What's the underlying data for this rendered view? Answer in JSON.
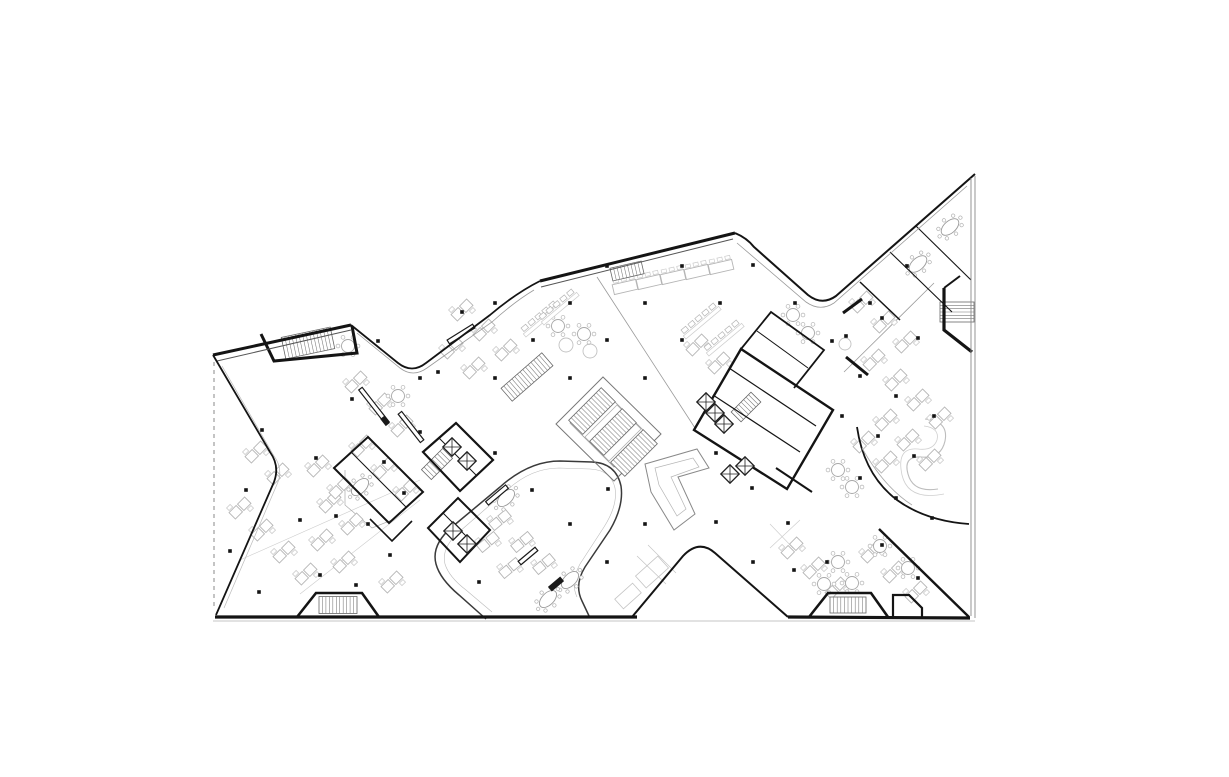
{
  "canvas": {
    "width": 1229,
    "height": 777,
    "background": "#ffffff"
  },
  "palette": {
    "paper": "#ffffff",
    "ink": "#141414",
    "wall": "#1c1c1c",
    "mid": "#555555",
    "light": "#b5b5b5",
    "faint": "#cccccc",
    "ghost": "#dddddd"
  },
  "plan": {
    "outline": [
      {
        "p": "M213,355 L351,325",
        "w": 3,
        "c": "#141414",
        "n": "facade-northwest-left-wing"
      },
      {
        "p": "M217,361 L351,330",
        "w": 1,
        "c": "#555555",
        "n": "facade-inner-line"
      },
      {
        "p": "M351,325 L398,363 Q412,374 426,363 L490,315 Q516,293 540,281",
        "w": 1.8,
        "c": "#141414",
        "n": "notch-top-left-edge"
      },
      {
        "p": "M357,333 L400,368 Q413,378 427,368 L492,322 Q514,302 534,290",
        "w": 0.8,
        "c": "#999999",
        "n": "notch-top-left-glass-line"
      },
      {
        "p": "M540,281 L735,233",
        "w": 3,
        "c": "#141414",
        "n": "facade-north-center-wing"
      },
      {
        "p": "M541,287 L733,239",
        "w": 1,
        "c": "#555555",
        "n": "facade-inner-line"
      },
      {
        "p": "M735,233 Q747,238 754,247 L808,295 Q822,306 836,296 L975,174",
        "w": 2,
        "c": "#141414",
        "n": "notch-top-right-edge"
      },
      {
        "p": "M737,243 L806,302 Q820,312 834,303 L967,186",
        "w": 0.8,
        "c": "#999999",
        "n": "notch-top-right-glass-line"
      },
      {
        "p": "M971,178 L971,616",
        "w": 0.9,
        "c": "#888888",
        "n": "facade-east-line"
      },
      {
        "p": "M975,176 L975,618",
        "w": 0.9,
        "c": "#888888",
        "n": "facade-east-line"
      },
      {
        "p": "M215,617 L637,617",
        "w": 3.2,
        "c": "#141414",
        "n": "facade-south-left"
      },
      {
        "p": "M632,617 L683,556 Q699,539 715,553 L788,617",
        "w": 2,
        "c": "#141414",
        "n": "notch-bottom-edge"
      },
      {
        "p": "M788,617 L970,618",
        "w": 3.2,
        "c": "#141414",
        "n": "facade-south-right"
      },
      {
        "p": "M213,621 L975,621",
        "w": 0.8,
        "c": "#b0b0b0",
        "n": "ground-shadow-line"
      },
      {
        "p": "M213,355 L270,452 Q280,466 274,482 L216,615",
        "w": 1.8,
        "c": "#141414",
        "n": "notch-west-edge"
      },
      {
        "p": "M214,362 L214,610",
        "w": 1,
        "c": "#888888",
        "s": "4 4",
        "n": "west-dashed-roof-line"
      },
      {
        "p": "M222,366 L274,456 Q283,468 278,482 L224,608",
        "w": 0.7,
        "c": "#bbbbbb",
        "n": "west-landscape-line"
      },
      {
        "p": "M879,529 L969,617",
        "w": 2.4,
        "c": "#141414",
        "n": "southeast-diagonal-wall"
      },
      {
        "p": "M857,427 Q864,475 897,500 Q926,521 969,524",
        "w": 1.8,
        "c": "#141414",
        "n": "terrace-boundary-curve"
      },
      {
        "p": "M862,448 Q884,487 912,505",
        "w": 0.8,
        "c": "#aaaaaa",
        "n": "terrace-inner-line"
      }
    ],
    "interior_lines": [
      {
        "p": "M486,619 L459,595 Q440,579 436,564 Q431,545 452,527 L500,487 Q529,461 560,461 L592,462 Q616,463 621,486 Q624,506 610,530 L585,567 Q574,585 582,601 L590,618",
        "w": 1.5,
        "c": "#3a3a3a",
        "n": "courtyard-loop-curve"
      },
      {
        "p": "M492,612 L466,590 Q449,577 445,564 Q441,548 459,532 L505,492 Q530,468 559,468 L590,469 Q611,470 615,488 Q618,505 604,527 L580,564 Q570,582 577,597",
        "w": 0.6,
        "c": "#bbbbbb",
        "n": "courtyard-loop-inner"
      },
      {
        "p": "M556,424 L603,377 L661,434 L614,481 Z",
        "w": 1,
        "c": "#777777",
        "n": "grand-stair-boundary"
      },
      {
        "p": "M570,423 L603,390 L647,434 L614,467 Z",
        "w": 0.8,
        "c": "#999999",
        "n": "grand-stair-inner"
      },
      {
        "p": "M585,437 L617,405 L641,429 L609,461 Z",
        "w": 0.7,
        "c": "#aaaaaa",
        "n": "grand-stair-inner"
      },
      {
        "p": "M645,464 L697,449 L709,468 L678,477 L695,514 L674,530 L651,492 Z",
        "w": 1,
        "c": "#888888",
        "n": "angular-feature-stair"
      },
      {
        "p": "M655,468 L693,458 L699,467 L671,477 L686,509 L677,516 L659,485 Z",
        "w": 0.7,
        "c": "#b5b5b5",
        "n": "angular-feature-inner"
      },
      {
        "p": "M925,419 Q949,421 945,441 Q941,459 921,457 Q903,456 908,474 Q913,493 938,489",
        "w": 1.1,
        "c": "#bdbdbd",
        "n": "terrace-garden-ribbon"
      },
      {
        "p": "M924,426 Q940,428 937,440 Q933,451 918,449 Q896,447 902,475 Q908,501 944,494",
        "w": 0.8,
        "c": "#cfcfcf",
        "n": "terrace-garden-ribbon"
      },
      {
        "p": "M597,277 L695,428",
        "w": 0.8,
        "c": "#9a9a9a",
        "n": "zone-divider-line"
      },
      {
        "p": "M844,372 L934,283",
        "w": 0.8,
        "c": "#9a9a9a",
        "n": "zone-divider-line"
      },
      {
        "p": "M240,560 L420,480",
        "w": 0.6,
        "c": "#cccccc",
        "n": "paving-guide-line"
      },
      {
        "p": "M300,594 L420,500",
        "w": 0.6,
        "c": "#cccccc",
        "n": "paving-guide-line"
      },
      {
        "p": "M770,548 L800,520",
        "w": 0.6,
        "c": "#cccccc",
        "n": "paving-guide-line"
      },
      {
        "p": "M770,524 L793,548",
        "w": 0.6,
        "c": "#cccccc",
        "n": "paving-guide-line"
      },
      {
        "p": "M345,470 L345,505 L372,528 L392,520",
        "w": 0.7,
        "c": "#aaaaaa",
        "n": "glass-partition-line"
      },
      {
        "p": "M637,556 L666,584 M648,545 L676,573",
        "w": 0.7,
        "c": "#c4c4c4",
        "n": "planter-guide-line"
      }
    ],
    "walls": [
      {
        "p": "M261,334 L274,361 L357,353 L352,326",
        "w": 3,
        "n": "stair-room-northwest"
      },
      {
        "p": "M423,452 L456,423 L493,460 L460,491 Z",
        "w": 2.2,
        "n": "core-left"
      },
      {
        "p": "M439,438 L476,475",
        "w": 1,
        "n": "core-left-partition"
      },
      {
        "p": "M334,468 L368,437 L423,492 L389,523 Z",
        "w": 2,
        "n": "meeting-room-left"
      },
      {
        "p": "M351,452 L406,507",
        "w": 1,
        "n": "meeting-room-left-partition"
      },
      {
        "p": "M370,519 L392,541 L412,521",
        "w": 1.6,
        "n": "meeting-room-left-annex"
      },
      {
        "p": "M428,528 L458,498 L490,530 L460,562 Z",
        "w": 2,
        "n": "service-room-center"
      },
      {
        "p": "M443,513 L475,545",
        "w": 1,
        "n": "service-room-partition"
      },
      {
        "p": "M694,430 L741,349 L833,410 L787,489 Z",
        "w": 2.4,
        "n": "core-right"
      },
      {
        "p": "M713,395 L800,452",
        "w": 1.2,
        "n": "core-right-partition"
      },
      {
        "p": "M729,368 L816,426",
        "w": 1.2,
        "n": "core-right-partition"
      },
      {
        "p": "M741,349 L771,312 L824,350 L794,388",
        "w": 1.8,
        "n": "room-north-of-core"
      },
      {
        "p": "M757,331 L808,368",
        "w": 1,
        "n": "room-partition"
      },
      {
        "p": "M843,313 L862,299",
        "w": 3,
        "n": "wall-segment"
      },
      {
        "p": "M846,357 L868,375",
        "w": 3,
        "n": "wall-segment"
      },
      {
        "p": "M944,288 L944,330 L972,352",
        "w": 3.2,
        "n": "stair-room-east"
      },
      {
        "p": "M944,288 L960,276",
        "w": 2,
        "n": "stair-room-east-wall"
      },
      {
        "p": "M297,617 L316,593 L362,593 L379,617",
        "w": 2.6,
        "n": "stair-room-south-left"
      },
      {
        "p": "M809,617 L828,593 L871,593 L888,617",
        "w": 2.6,
        "n": "stair-room-south-right"
      },
      {
        "p": "M893,617 L893,595 L909,595 L922,608 L922,617",
        "w": 2.2,
        "n": "annex-room-south-right"
      },
      {
        "p": "M890,252 L952,312",
        "w": 1.1,
        "n": "meeting-partition-northeast"
      },
      {
        "p": "M916,226 L971,280",
        "w": 1.1,
        "n": "meeting-partition-northeast"
      },
      {
        "p": "M860,282 L900,320",
        "w": 1.5,
        "n": "meeting-partition-northeast"
      },
      {
        "p": "M776,468 L812,492",
        "w": 2,
        "n": "wall-segment"
      }
    ],
    "stairs": [
      [
        308,
        343,
        50,
        22,
        -12
      ],
      [
        527,
        377,
        54,
        17,
        -41
      ],
      [
        437,
        464,
        30,
        14,
        -45
      ],
      [
        746,
        407,
        28,
        14,
        -45
      ],
      [
        957,
        312,
        20,
        34,
        90
      ],
      [
        338,
        605,
        38,
        17,
        0
      ],
      [
        848,
        605,
        36,
        16,
        0
      ],
      [
        592,
        411,
        46,
        20,
        -45
      ],
      [
        613,
        432,
        46,
        20,
        -45
      ],
      [
        634,
        453,
        46,
        20,
        -45
      ],
      [
        627,
        271,
        32,
        13,
        -13
      ]
    ],
    "elevators": [
      [
        452,
        447
      ],
      [
        467,
        461
      ],
      [
        706,
        402
      ],
      [
        715,
        413
      ],
      [
        724,
        424
      ],
      [
        745,
        466
      ],
      [
        730,
        474
      ],
      [
        453,
        531
      ],
      [
        467,
        544
      ]
    ],
    "columns": [
      [
        378,
        341
      ],
      [
        438,
        372
      ],
      [
        462,
        312
      ],
      [
        495,
        303
      ],
      [
        533,
        340
      ],
      [
        570,
        303
      ],
      [
        607,
        266
      ],
      [
        645,
        303
      ],
      [
        682,
        266
      ],
      [
        720,
        303
      ],
      [
        753,
        265
      ],
      [
        795,
        303
      ],
      [
        832,
        341
      ],
      [
        870,
        303
      ],
      [
        907,
        266
      ],
      [
        607,
        340
      ],
      [
        682,
        340
      ],
      [
        420,
        378
      ],
      [
        495,
        378
      ],
      [
        570,
        378
      ],
      [
        645,
        378
      ],
      [
        262,
        430
      ],
      [
        246,
        490
      ],
      [
        230,
        551
      ],
      [
        259,
        592
      ],
      [
        300,
        520
      ],
      [
        316,
        458
      ],
      [
        352,
        399
      ],
      [
        336,
        516
      ],
      [
        320,
        575
      ],
      [
        384,
        462
      ],
      [
        368,
        524
      ],
      [
        356,
        585
      ],
      [
        420,
        432
      ],
      [
        404,
        493
      ],
      [
        390,
        555
      ],
      [
        846,
        336
      ],
      [
        882,
        318
      ],
      [
        918,
        338
      ],
      [
        860,
        376
      ],
      [
        896,
        396
      ],
      [
        934,
        416
      ],
      [
        842,
        416
      ],
      [
        878,
        436
      ],
      [
        914,
        456
      ],
      [
        860,
        478
      ],
      [
        896,
        498
      ],
      [
        932,
        518
      ],
      [
        495,
        453
      ],
      [
        532,
        490
      ],
      [
        570,
        524
      ],
      [
        608,
        489
      ],
      [
        645,
        524
      ],
      [
        479,
        582
      ],
      [
        607,
        562
      ],
      [
        716,
        453
      ],
      [
        716,
        522
      ],
      [
        752,
        488
      ],
      [
        788,
        523
      ],
      [
        753,
        562
      ],
      [
        827,
        562
      ],
      [
        882,
        545
      ],
      [
        918,
        578
      ],
      [
        794,
        570
      ]
    ],
    "desks": [
      [
        256,
        452,
        -45
      ],
      [
        278,
        474,
        -45
      ],
      [
        240,
        508,
        -45
      ],
      [
        262,
        530,
        -45
      ],
      [
        284,
        552,
        -45
      ],
      [
        306,
        574,
        -45
      ],
      [
        322,
        540,
        -45
      ],
      [
        344,
        562,
        -45
      ],
      [
        330,
        502,
        -45
      ],
      [
        352,
        524,
        -45
      ],
      [
        318,
        466,
        -45
      ],
      [
        340,
        488,
        -45
      ],
      [
        362,
        446,
        -45
      ],
      [
        384,
        468,
        -45
      ],
      [
        406,
        490,
        -45
      ],
      [
        392,
        582,
        -45
      ],
      [
        356,
        382,
        -45
      ],
      [
        380,
        404,
        -45
      ],
      [
        402,
        426,
        -45
      ],
      [
        452,
        348,
        -45
      ],
      [
        474,
        368,
        -45
      ],
      [
        462,
        310,
        -45
      ],
      [
        484,
        330,
        -45
      ],
      [
        506,
        350,
        -45
      ],
      [
        697,
        345,
        -45
      ],
      [
        719,
        363,
        -45
      ],
      [
        862,
        302,
        -45
      ],
      [
        884,
        322,
        -45
      ],
      [
        906,
        342,
        -45
      ],
      [
        874,
        360,
        -45
      ],
      [
        896,
        380,
        -45
      ],
      [
        918,
        400,
        -45
      ],
      [
        940,
        418,
        -45
      ],
      [
        886,
        420,
        -45
      ],
      [
        908,
        440,
        -45
      ],
      [
        930,
        460,
        -45
      ],
      [
        864,
        442,
        -45
      ],
      [
        886,
        462,
        -45
      ],
      [
        792,
        548,
        -45
      ],
      [
        814,
        568,
        -45
      ],
      [
        836,
        588,
        -45
      ],
      [
        872,
        552,
        -45
      ],
      [
        894,
        572,
        -45
      ],
      [
        916,
        592,
        -45
      ],
      [
        500,
        520,
        -40
      ],
      [
        522,
        542,
        -40
      ],
      [
        488,
        542,
        -40
      ],
      [
        510,
        568,
        -40
      ],
      [
        544,
        564,
        -40
      ]
    ],
    "round_tables": [
      [
        558,
        326
      ],
      [
        584,
        334
      ],
      [
        793,
        315
      ],
      [
        808,
        333
      ],
      [
        838,
        470
      ],
      [
        852,
        487
      ],
      [
        838,
        562
      ],
      [
        824,
        584
      ],
      [
        852,
        583
      ],
      [
        880,
        546
      ],
      [
        908,
        568
      ],
      [
        348,
        346
      ],
      [
        398,
        396
      ]
    ],
    "plain_circles": [
      [
        566,
        345,
        7
      ],
      [
        590,
        351,
        7
      ],
      [
        845,
        344,
        6
      ]
    ],
    "oval_tables": [
      [
        950,
        227,
        -42
      ],
      [
        918,
        264,
        -42
      ],
      [
        360,
        487,
        -45
      ],
      [
        506,
        498,
        -45
      ],
      [
        570,
        580,
        -45
      ],
      [
        548,
        599,
        -45
      ]
    ],
    "long_tables": [
      [
        625,
        287,
        -13
      ],
      [
        649,
        282,
        -13
      ],
      [
        673,
        277,
        -13
      ],
      [
        697,
        272,
        -13
      ],
      [
        721,
        267,
        -13
      ]
    ],
    "bench_rows": [
      [
        700,
        320,
        -40
      ],
      [
        723,
        337,
        -40
      ],
      [
        540,
        318,
        -40
      ],
      [
        558,
        306,
        -40
      ]
    ],
    "counters": [
      [
        374,
        406,
        44,
        52
      ],
      [
        411,
        427,
        36,
        52
      ],
      [
        461,
        334,
        30,
        -32
      ],
      [
        497,
        495,
        26,
        -40
      ],
      [
        528,
        556,
        22,
        -40
      ]
    ],
    "dark_marks": [
      [
        556,
        584,
        16,
        6,
        -40
      ],
      [
        385,
        421,
        9,
        5,
        52
      ]
    ],
    "ghost_rects": [
      [
        652,
        572,
        30,
        16,
        -42
      ],
      [
        628,
        596,
        24,
        13,
        -42
      ]
    ]
  }
}
